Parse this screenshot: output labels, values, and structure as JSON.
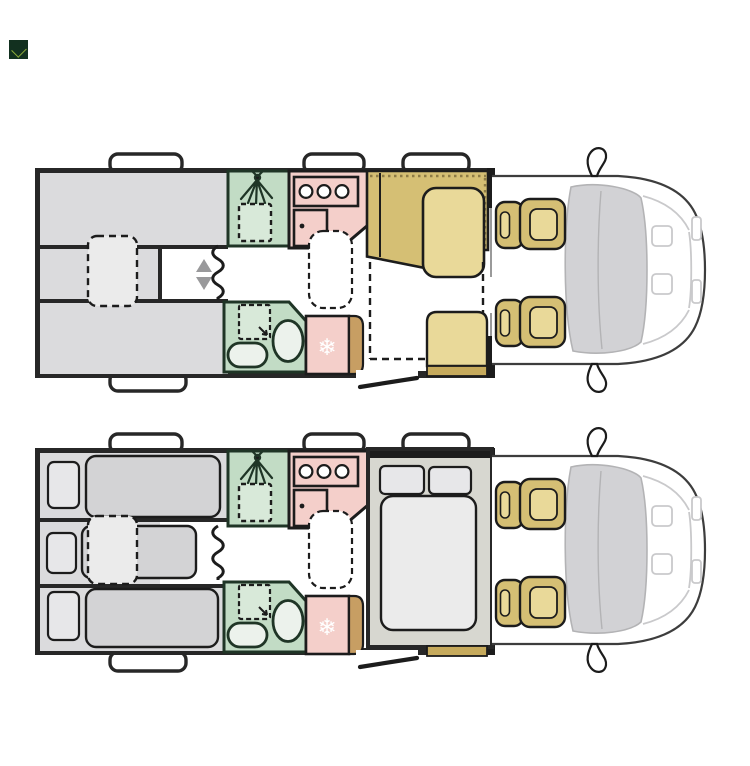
{
  "page": {
    "background": "#ffffff"
  },
  "logo": {
    "bg": "#12301f",
    "mark": "#8fae3a"
  },
  "plans": [
    {
      "name": "day-layout"
    },
    {
      "name": "night-layout"
    }
  ],
  "icons": {
    "snowflake_glyph": "❄",
    "shower_icon": "shower-spray",
    "toilet_icon": "toilet",
    "sink_icon": "sink",
    "hob_icon": "three-burner-hob",
    "updown_arrows": "adjustable-arrows"
  },
  "colors": {
    "white": "#ffffff",
    "outline": "#272727",
    "dark": "#1c1c1c",
    "gray_area": "#dbdbdd",
    "gray_mattress": "#d3d3d5",
    "gray_light": "#ebebeb",
    "pillow": "#e7e7e9",
    "green_room": "#c2dcc5",
    "green_light": "#d8e9d9",
    "green_fixture": "#ecf2ec",
    "green_outline": "#1f3526",
    "pink_room": "#f4cfca",
    "khaki": "#d5bf74",
    "khaki_light": "#e9d999",
    "khaki_dark": "#c6aa5c",
    "tan_dark": "#c79e63",
    "bedframe": "#d7d7d0",
    "windshield": "#d2d2d5",
    "windshield_edge": "#b3b3b5",
    "cab_line": "#c9c9cb",
    "cab_outline": "#3d3d3d",
    "arrow": "#99999b",
    "hatch": "#8d7b46",
    "thinwall": "#9a9a9a",
    "logo_bg": "#12301f",
    "logo_mark": "#8fae3a"
  }
}
